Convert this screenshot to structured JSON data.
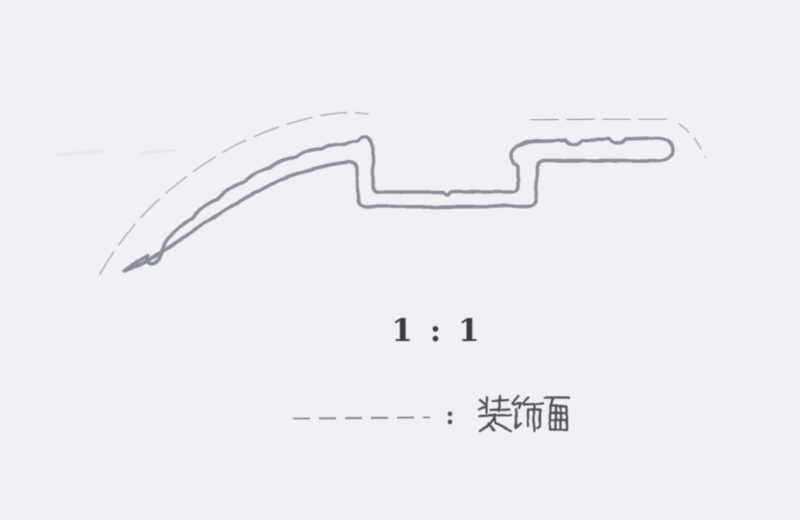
{
  "paper": {
    "background_color": "#f2f2f6",
    "grain_color": "#8d8da0"
  },
  "drawing": {
    "scale_label": "1 : 1",
    "legend": {
      "separator": ":",
      "label": "装饰面"
    },
    "colors": {
      "profile_line": "#8b8d99",
      "surface_dash_line": "#aeb0bd",
      "surface_dash_top": "#9fa1ae",
      "legend_dash": "#8f919d",
      "scale_text": "#3a3a42",
      "legend_text": "#4f4f57",
      "smudge": "#d9dae3"
    },
    "paths": {
      "profile_outline": "M124,271 L136,263 L148,256 C145,260 148,265 154,263 C162,260 162,249 166,242 Q176,227 192,219 Q202,205 218,199 Q228,187 244,182 Q254,171 270,168 Q280,159 296,157 Q306,149 322,149 Q331,143 345,144 Q350,141 358,141 C361,136 366,136 369,140 Q372,143 373,149 L373,185 Q373,192 380,192 L444,192 Q447,197 451,192 L511,192 Q518,192 518,185 L518,166 L513,163 Q510,158 512,152 Q514,147 519,145 L527,142 L534,141 L566,140 C570,146 578,146 582,140 L610,139 C614,145 622,145 626,139 L653,138 C665,137 673,142 673,150 C673,158 664,162 653,161 L546,161 Q538,161 537,169 L536,197 Q536,206 527,206 L367,207 Q358,207 358,198 L357,170 Q356,163 348,162 C330,164 306,170 282,179 C256,191 230,206 204,223 C178,242 156,257 140,265 Z",
      "surface_dash_curve": "M100,274 C114,249 132,226 152,206 C176,183 203,163 232,147 C261,132 292,121 324,115 C340,112 355,112 368,114",
      "surface_dash_top": "M531,120 L600,119 L668,119",
      "surface_dash_end": "M679,124 C690,131 699,143 705,157",
      "legend_dash_line": "M293,419 L430,417",
      "legend_glyphs": "M480,400 L485,404 M479,409 L485,407 M487,397 L487,413 M500,396 L500,411 M493,401 L508,400 M491,410 L510,409 M479,416 L511,415 M496,416 C492,422 487,427 480,431 M495,415 L495,423 M495,423 C501,425 506,428 511,431 M488,424 L494,430 M518,396 L513,403 M514,404 L521,403 L519,408 M516,409 L516,428 M516,428 L521,424 M528,397 L523,404 M524,405 L543,404 M528,410 L528,426 M528,410 L540,410 M540,410 L540,426 L537,428 M534,406 L534,431 M545,398 L569,398 M553,399 L551,405 M550,406 L567,406 L567,430 L550,430 L550,406 M556,406 L556,430 M561,406 L561,430 M551,413 L566,413 M551,420 L566,420",
      "smudge": "M55,155 L104,151 M140,153 L177,150"
    }
  }
}
